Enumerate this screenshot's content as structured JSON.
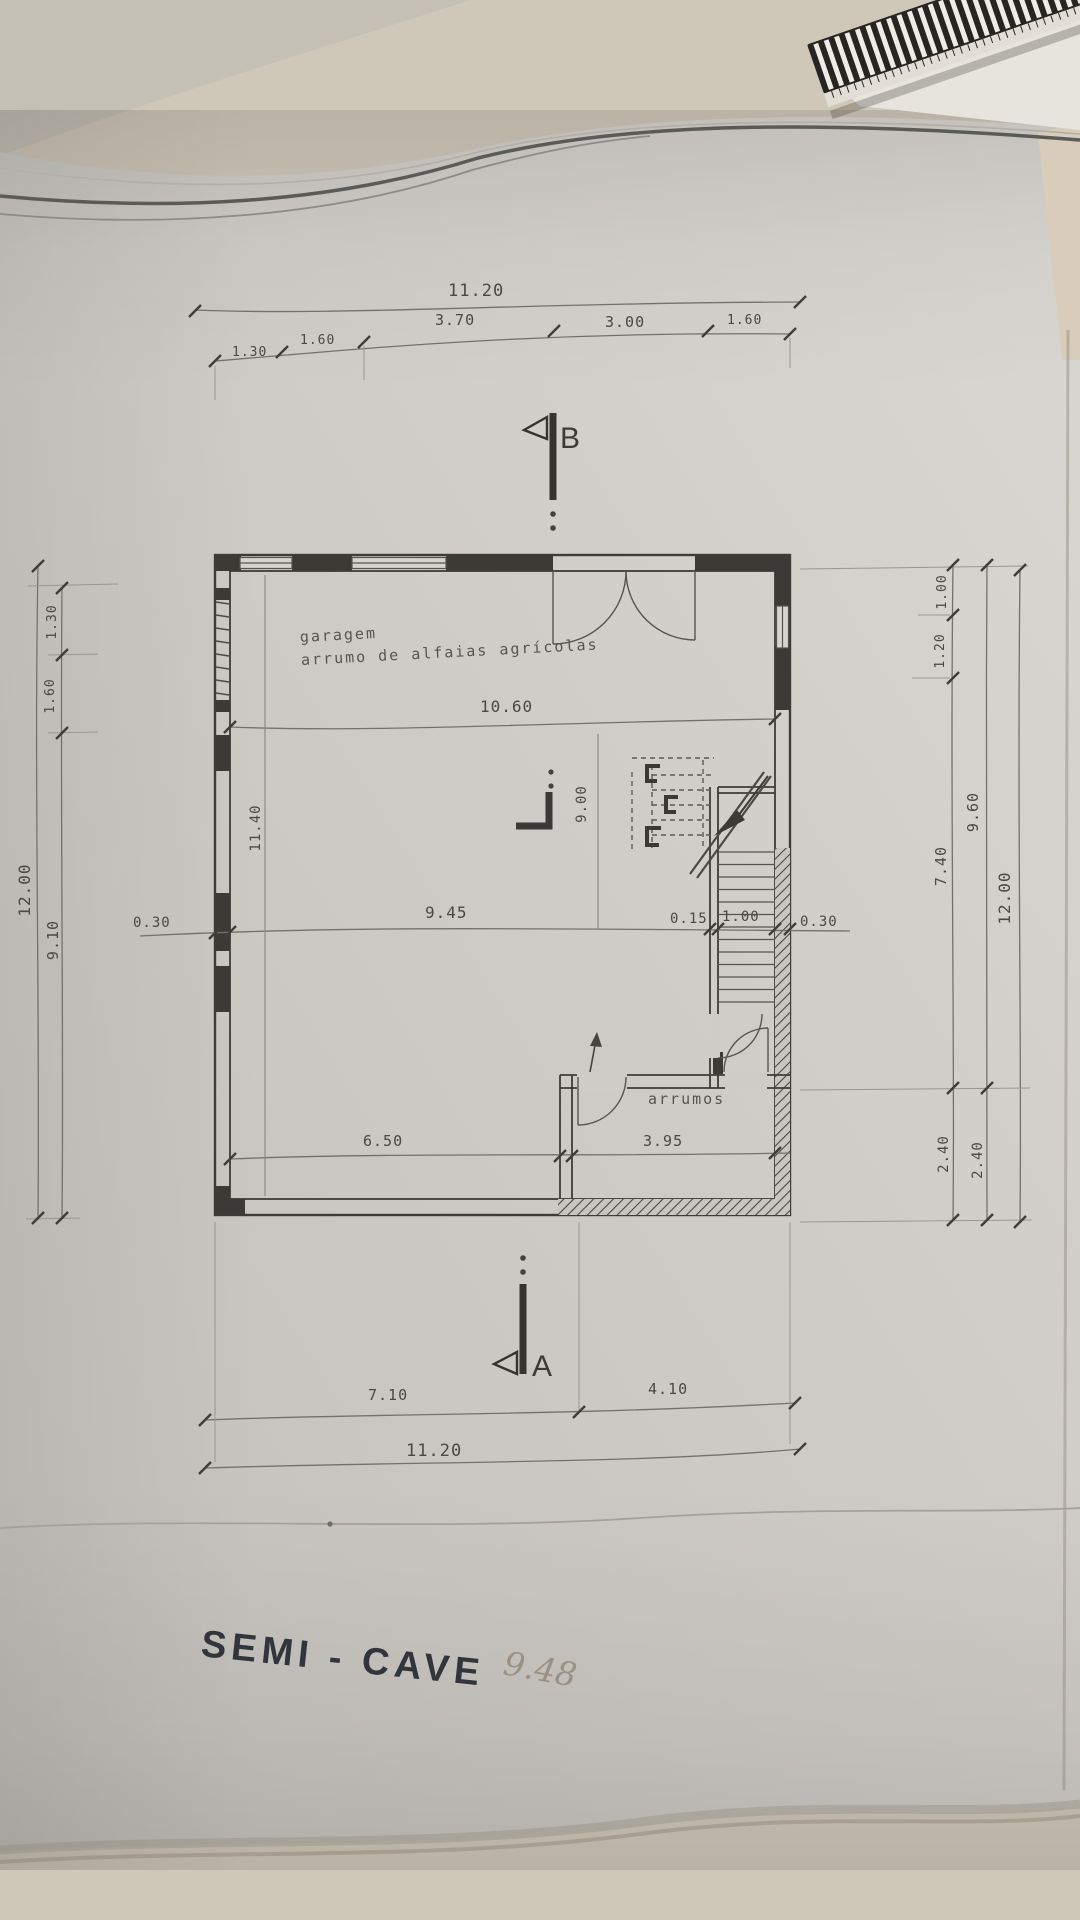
{
  "scene": {
    "paper_color": "#cfccc6",
    "desk_color": "#cfc7b8",
    "ink_color": "#45433f",
    "wall_color": "#3b3a37"
  },
  "plan": {
    "title": "SEMI - CAVE",
    "handwritten_note": "9.48",
    "rooms": {
      "garage_label_line1": "garagem",
      "garage_label_line2": "arrumo de alfaias agrícolas",
      "storage_label": "arrumos"
    },
    "sections": {
      "top_marker": "B",
      "bottom_marker": "A"
    },
    "dims": {
      "top_total": "11.20",
      "top_chain": [
        "1.30",
        "1.60",
        "3.70",
        "3.00",
        "1.60"
      ],
      "interior_width": "10.60",
      "mid_chain": [
        "0.30",
        "9.45",
        "0.15",
        "1.00",
        "0.30"
      ],
      "bottom_interior": [
        "6.50",
        "3.95"
      ],
      "bottom_chain": [
        "7.10",
        "4.10"
      ],
      "bottom_total": "11.20",
      "left_total": "12.00",
      "left_chain": [
        "1.30",
        "1.60",
        "9.10"
      ],
      "interior_height_left": "11.40",
      "interior_height_mid": "9.00",
      "right_chain_inner": [
        "1.00",
        "1.20",
        "7.40",
        "2.40"
      ],
      "right_chain_mid": [
        "9.60",
        "2.40"
      ],
      "right_total": "12.00"
    }
  }
}
